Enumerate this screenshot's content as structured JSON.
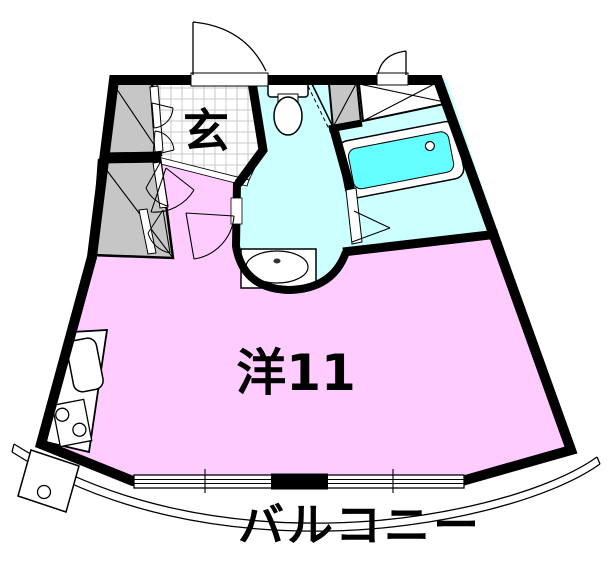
{
  "plan": {
    "type": "apartment-floor-plan",
    "labels": {
      "entrance": "玄",
      "main_room": "洋11",
      "balcony": "バルコニー"
    },
    "colors": {
      "room_pink": "#FFCCFF",
      "wet_area": "#CCFFFF",
      "bathtub_water": "#66FFFF",
      "closet_gray": "#C6C6C6",
      "tile_grid": "#C8C8C8",
      "wall": "#000000",
      "background": "#FFFFFF"
    },
    "fixtures": [
      "entrance-door",
      "service-door",
      "toilet",
      "bathtub",
      "washbasin",
      "kitchen-sink",
      "gas-stove",
      "washing-machine-pan",
      "closet-upper",
      "closet-lower",
      "storage-cross-space",
      "window-sliding",
      "balcony-railing"
    ]
  }
}
